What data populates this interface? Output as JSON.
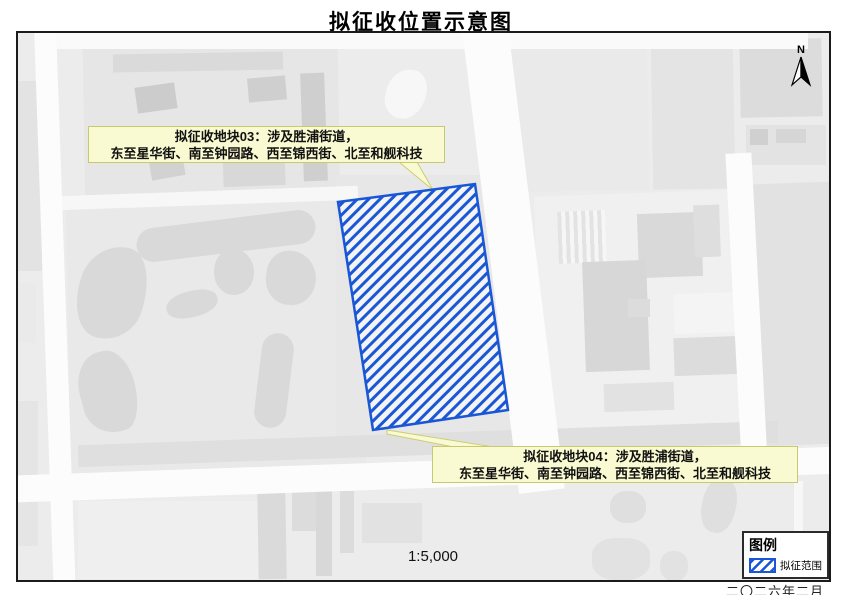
{
  "title": "拟征收位置示意图",
  "map": {
    "north_label": "N",
    "scale_text": "1:5,000",
    "labels": [
      {
        "id": "03",
        "line1": "拟征收地块03：涉及胜浦街道，",
        "line2": "东至星华街、南至钟园路、西至锦西街、北至和舰科技"
      },
      {
        "id": "04",
        "line1": "拟征收地块04：涉及胜浦街道，",
        "line2": "东至星华街、南至钟园路、西至锦西街、北至和舰科技"
      }
    ]
  },
  "legend": {
    "title": "图例",
    "items": [
      {
        "label": "拟征范围",
        "symbol": "blue-diagonal-hatch"
      }
    ]
  },
  "date_text": "二〇二六年二月",
  "colors": {
    "hatch_blue": "#1a57d6",
    "callout_yellow": "#fafad2",
    "map_base_gray": "#ececec"
  }
}
